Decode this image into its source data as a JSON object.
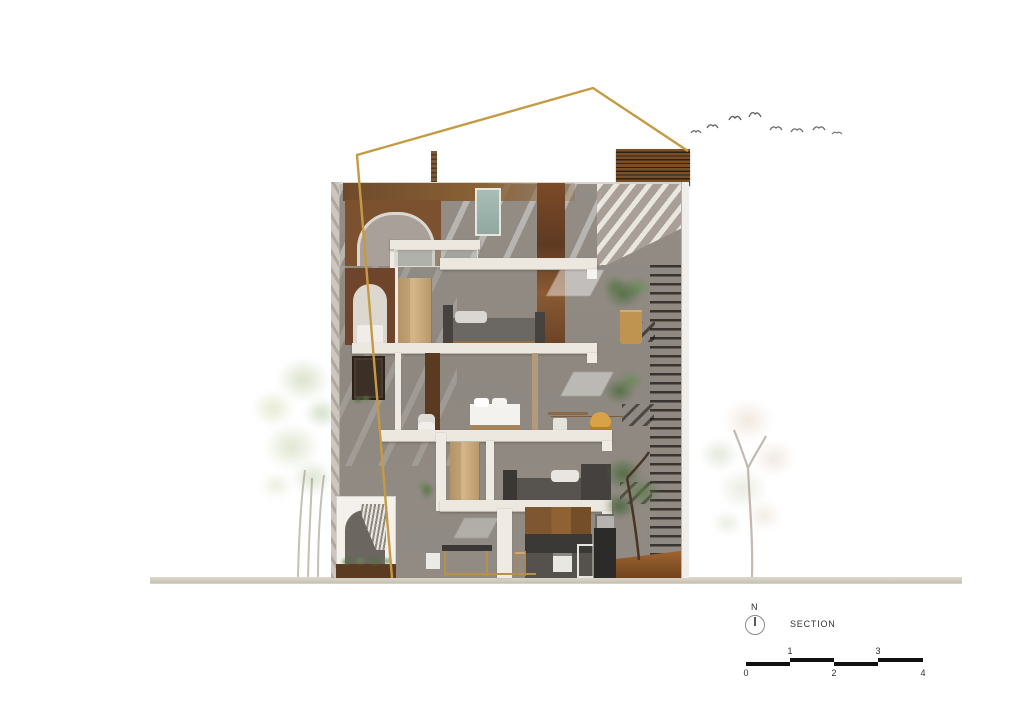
{
  "drawing": {
    "type": "architectural-section-rendering",
    "label": "SECTION",
    "north_label": "N"
  },
  "scale_bar": {
    "above": [
      "1",
      "3"
    ],
    "below": [
      "0",
      "2",
      "4"
    ]
  },
  "colors": {
    "accent_gold": "#C49B44",
    "wall_gray": "#8E8881",
    "slab_white": "#ECE8E0",
    "wood_brown": "#7E5630",
    "corten_rust": "#744627",
    "glass_teal": "#9DB4AE",
    "ground_beige": "#D8D2C6",
    "foliage_green": "#5F7F4C",
    "ink": "#2E2E2E"
  },
  "icons": {
    "north-compass-icon": "circle-with-needle",
    "bird-icon": "gull-silhouette"
  },
  "scene": {
    "elements": [
      "gold-section-outline-roof",
      "four-storey-building-section",
      "rooftop-louver-vent",
      "interior-staircase",
      "louver-screen-right-wall",
      "arched-openings",
      "bedrooms-with-beds",
      "kitchen-ground-floor",
      "indoor-tree",
      "potted-plants",
      "watercolor-tree-left",
      "watercolor-tree-right",
      "flock-of-birds",
      "ground-line"
    ]
  }
}
